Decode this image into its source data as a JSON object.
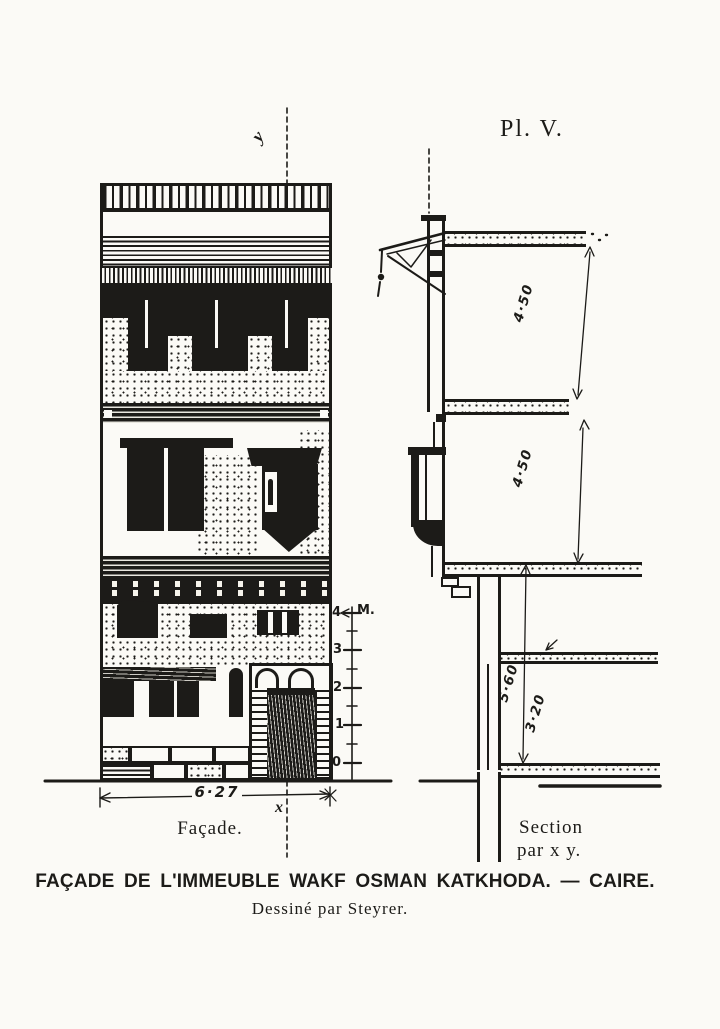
{
  "plate_label": "Pl. V.",
  "colors": {
    "ink": "#1c1b18",
    "paper": "#fbfaf6"
  },
  "facade": {
    "caption": "Façade.",
    "width_dimension": "6·27",
    "section_line_labels": {
      "top": "y",
      "bottom": "x"
    },
    "scale_bar": {
      "unit": "M.",
      "ticks": [
        "4",
        "3",
        "2",
        "1",
        "0"
      ]
    }
  },
  "section": {
    "caption_line1": "Section",
    "caption_line2": "par x y.",
    "dimensions": {
      "top_storey": "4·50",
      "middle_storey": "4·50",
      "ground_total": "5·60",
      "ground_upper": "3·20"
    }
  },
  "caption": {
    "title": "FAÇADE DE L'IMMEUBLE WAKF OSMAN KATKHODA. — CAIRE.",
    "credit": "Dessiné par Steyrer."
  }
}
